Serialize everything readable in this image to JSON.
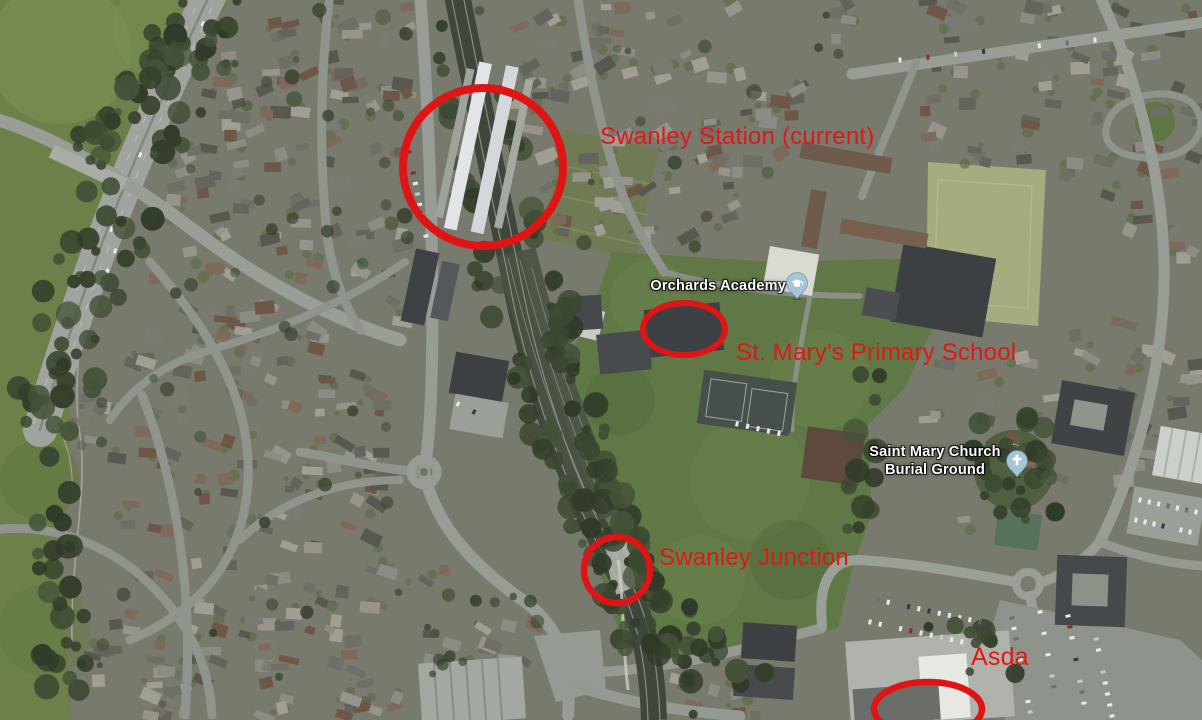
{
  "annotations": {
    "color": "#df1515",
    "station": "Swanley Station (current)",
    "school": "St. Mary's Primary School",
    "junction": "Swanley Junction",
    "asda": "Asda"
  },
  "map_labels": {
    "orchards_academy": "Orchards Academy",
    "saint_mary_line1": "Saint Mary Church",
    "saint_mary_line2": "Burial Ground"
  }
}
